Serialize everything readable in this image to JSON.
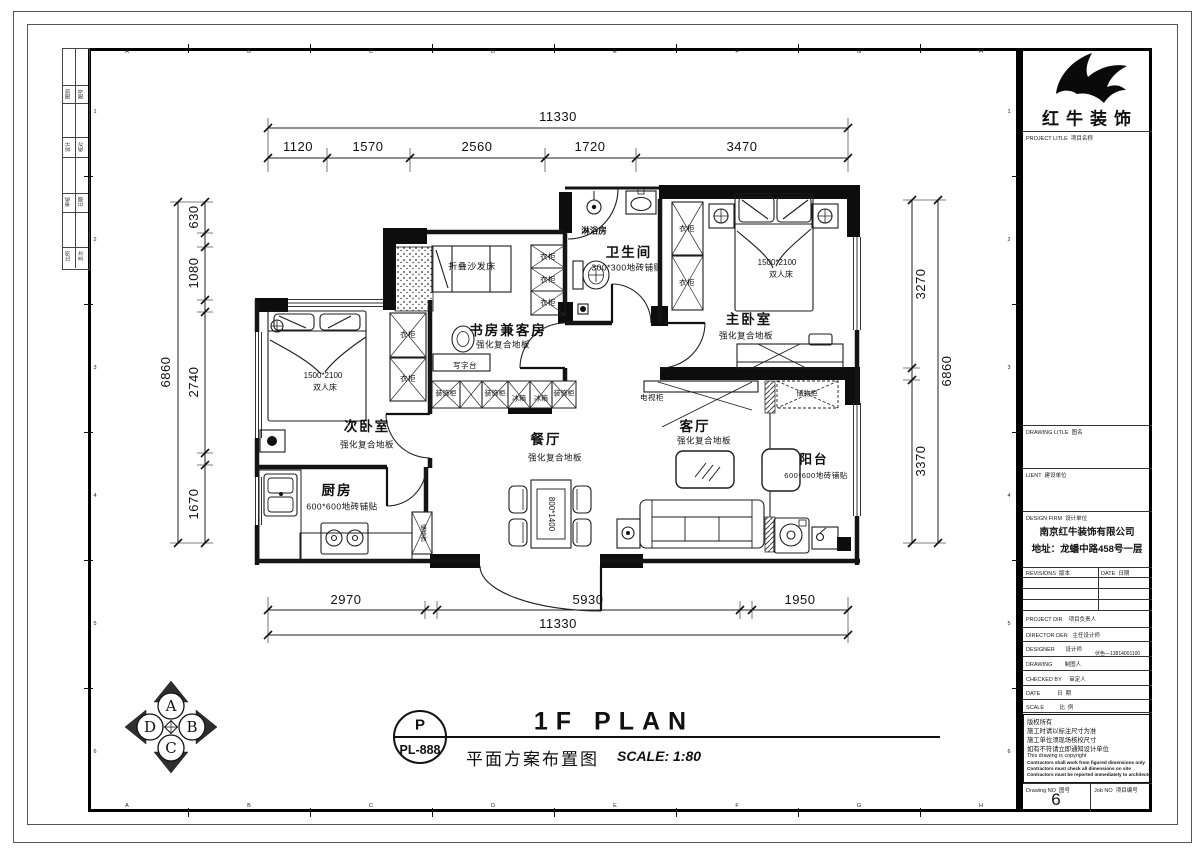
{
  "sheet": {
    "grid_letters": [
      "A",
      "B",
      "C",
      "D",
      "E",
      "F",
      "G",
      "H"
    ],
    "grid_numbers": [
      "1",
      "2",
      "3",
      "4",
      "5",
      "6"
    ]
  },
  "fold_strip": {
    "labels": [
      "图别",
      "图号",
      "设计",
      "校对",
      "审核",
      "日期",
      "比例",
      "页次"
    ]
  },
  "plan": {
    "dims": {
      "top_total": "11330",
      "top_segments": [
        "1120",
        "1570",
        "2560",
        "1720",
        "3470"
      ],
      "bottom_total": "11330",
      "bottom_segments": [
        "2970",
        "5930",
        "1950"
      ],
      "left_total": "6860",
      "left_segments": [
        "630",
        "1080",
        "2740",
        "1670"
      ],
      "right_total": "6860",
      "right_segments": [
        "3270",
        "3370"
      ]
    },
    "rooms": {
      "master": {
        "name": "主卧室",
        "floor": "强化复合地板"
      },
      "second": {
        "name": "次卧室",
        "floor": "强化复合地板"
      },
      "study": {
        "name": "书房兼客房",
        "floor": "强化复合地板"
      },
      "living": {
        "name": "客厅",
        "floor": "强化复合地板"
      },
      "dining": {
        "name": "餐厅",
        "floor": "强化复合地板"
      },
      "kitchen": {
        "name": "厨房",
        "floor": "600*600地砖铺贴"
      },
      "bath": {
        "name": "卫生间",
        "floor": "300*300地砖铺贴"
      },
      "balcony": {
        "name": "阳台",
        "floor": "600*600地砖铺贴"
      },
      "shower": {
        "name": "淋浴房"
      }
    },
    "items": {
      "wardrobe": "衣柜",
      "sofa_bed": "折叠沙发床",
      "desk": "写字台",
      "deco_cabinet": "装饰柜",
      "fridge": "冰箱",
      "tv_cabinet": "电视柜",
      "storage": "储物柜",
      "bed_size": "1500*2100",
      "double_bed": "双人床",
      "table_size": "800*1400"
    }
  },
  "title_bar": {
    "tag_top": "P",
    "tag_bottom": "PL-888",
    "title_en": "1F PLAN",
    "title_cn": "平面方案布置图",
    "scale": "SCALE: 1:80"
  },
  "compass": {
    "top": "A",
    "right": "B",
    "bottom": "C",
    "left": "D"
  },
  "title_block": {
    "logo_name": "红牛装饰",
    "project_label": "PROJECT LITLE  项目名称",
    "drawing_label": "DRAWING LITLE  图名",
    "client_label": "LIENT  建设单位",
    "firm_label": "DESIGN FIRM  设计单位",
    "firm_name": "南京红牛装饰有限公司",
    "firm_addr": "地址：龙蟠中路458号一层",
    "revisions_label": "REVISIONS  版本",
    "date_label": "DATE  日期",
    "rows": [
      "PROJECT DIR    项目负责人",
      "DIRECTOR DER   主任设计师",
      "DESIGNER       设计师",
      "DRAWING        制图人",
      "CHECKED BY     审定人",
      "DATE           日  期",
      "SCALE          比  例"
    ],
    "designer_contact": "伏色—13814001100",
    "copyright": [
      "版权所有",
      "施工时请以标注尺寸为准",
      "施工单位须现场核校尺寸",
      "如有不符请立即通知设计单位",
      "This drawing is copyright",
      "Contractors shall work from figured dimensions only",
      "Contractors must check all dimensions on site",
      "Contractors must be reported immediately to architects"
    ],
    "drawing_no_label": "Drawing NO  图号",
    "drawing_no": "6",
    "job_no_label": "Job NO  项目编号"
  }
}
